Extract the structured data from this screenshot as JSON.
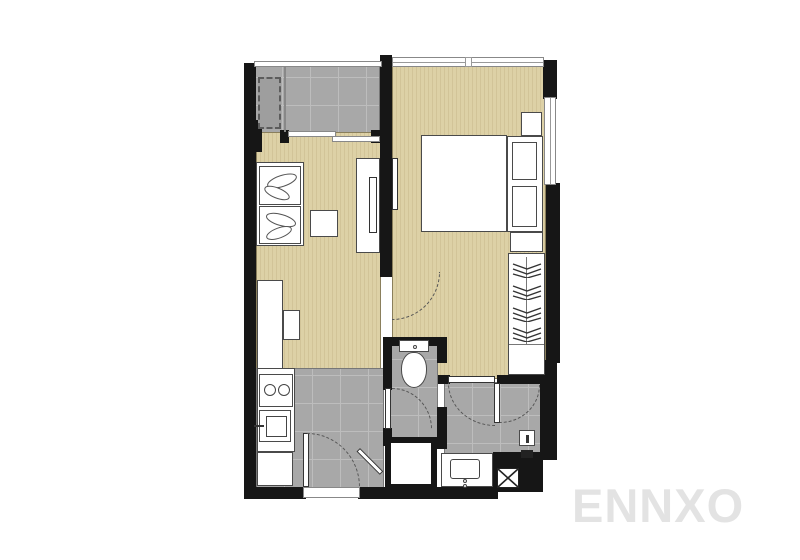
{
  "watermark": {
    "text": "ENNXO"
  },
  "colors": {
    "wall": "#161616",
    "wood": "#ddd1a6",
    "wood2": "#d2c498",
    "tile": "#a8a8a8",
    "tileline": "#bdbdbd",
    "tiledark": "#9e9e9e",
    "fixline": "#4a4a4a",
    "arc": "#555555",
    "wm": "#e3e3e3"
  },
  "fixtures": [
    "washing-machine-icon",
    "balcony-sliding-door-icon",
    "sofa-icon",
    "leaf-cushion-icon",
    "coffee-table-icon",
    "tv-console-icon",
    "tv-icon",
    "bed-icon",
    "pillow-icon",
    "nightstand-icon",
    "wardrobe-icon",
    "clothes-hanger-icon",
    "kitchen-counter-icon",
    "stove-burner-icon",
    "kitchen-sink-icon",
    "refrigerator-icon",
    "toilet-icon",
    "shower-stall-icon",
    "vanity-sink-icon",
    "water-heater-icon",
    "floor-drain-icon",
    "door-swing-arc-icon",
    "window-icon"
  ]
}
